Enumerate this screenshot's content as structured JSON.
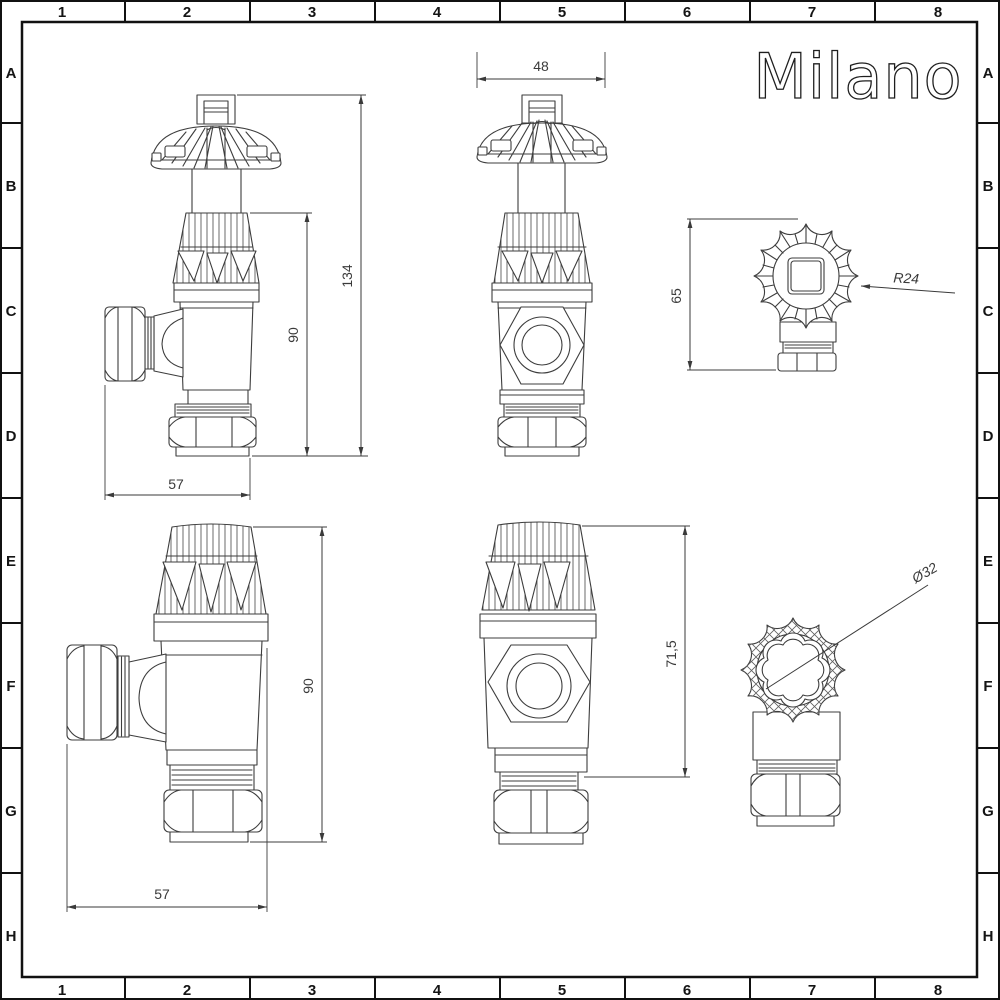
{
  "page": {
    "background": "#ffffff",
    "drawing_line_color": "#3d3d3d",
    "frame_color": "#111111"
  },
  "brand": {
    "logo_text": "Milano"
  },
  "grid": {
    "columns": [
      "1",
      "2",
      "3",
      "4",
      "5",
      "6",
      "7",
      "8"
    ],
    "rows": [
      "A",
      "B",
      "C",
      "D",
      "E",
      "F",
      "G",
      "H"
    ]
  },
  "drawing": {
    "views": {
      "angle_valve_side": {
        "dimensions": {
          "total_height": "134",
          "body_height": "90",
          "width": "57"
        }
      },
      "angle_valve_front": {
        "dimensions": {
          "handwheel_width": "48"
        }
      },
      "angle_valve_top": {
        "dimensions": {
          "assembly_height": "65",
          "handwheel_radius": "R24"
        }
      },
      "lockshield_valve_side": {
        "dimensions": {
          "height": "90",
          "width": "57"
        }
      },
      "lockshield_valve_front": {
        "dimensions": {
          "height": "71,5"
        }
      },
      "lockshield_valve_top": {
        "dimensions": {
          "cap_diameter": "Ø32"
        }
      }
    }
  }
}
